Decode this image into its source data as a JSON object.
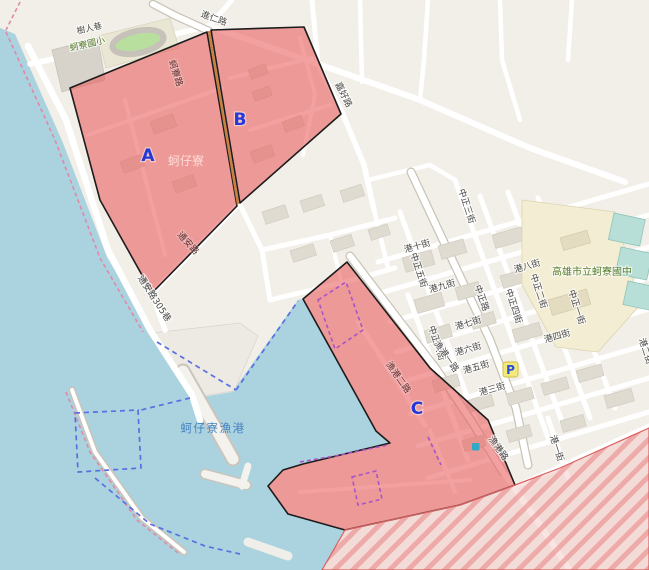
{
  "map": {
    "zones": {
      "a_label": "A",
      "b_label": "B",
      "c_label": "C"
    },
    "places": {
      "elementary_school": "蚵寮國小",
      "junior_high": "高雄市立蚵寮國中",
      "village": "蚵仔寮",
      "fishing_port": "蚵仔寮漁港",
      "parking": "P"
    },
    "streets": {
      "shuren_lane": "樹人巷",
      "jinren_rd": "進仁路",
      "jiahao_rd": "嘉好路",
      "keliao_rd": "蚵寮路",
      "tongan_rd": "通安路",
      "tongan_305": "通安路305巷",
      "zhongzheng_rd": "中正路",
      "zhongzheng_1": "中正一街",
      "zhongzheng_2": "中正二街",
      "zhongzheng_3": "中正三街",
      "zhongzheng_4": "中正四街",
      "zhongzheng_5": "中正五街",
      "zhongzheng_6": "中正六街",
      "gang_1": "港一街",
      "gang_2": "港二街",
      "gang_3": "港三街",
      "gang_4": "港四街",
      "gang_5": "港五街",
      "gang_6": "港六街",
      "gang_7": "港七街",
      "gang_8": "港八街",
      "gang_9": "港九街",
      "gang_10": "港十街",
      "yugang_rd": "漁港路",
      "yugang_1": "漁港一路",
      "yugang_2": "漁港二路"
    },
    "colors": {
      "water": "#aad3df",
      "land": "#f2efe9",
      "zone_fill": "#e85c5c",
      "zone_border": "#1c1c1c",
      "hatch_stripe": "#e98f8f",
      "port_boundary_blue": "#5a6fe0",
      "inner_boundary_magenta": "#a855c8",
      "coast_dash_pink": "#e089a8",
      "zone_label_blue": "#2438d8",
      "poi_green": "#567d2e",
      "parking_yellow": "#f2e87c"
    }
  }
}
